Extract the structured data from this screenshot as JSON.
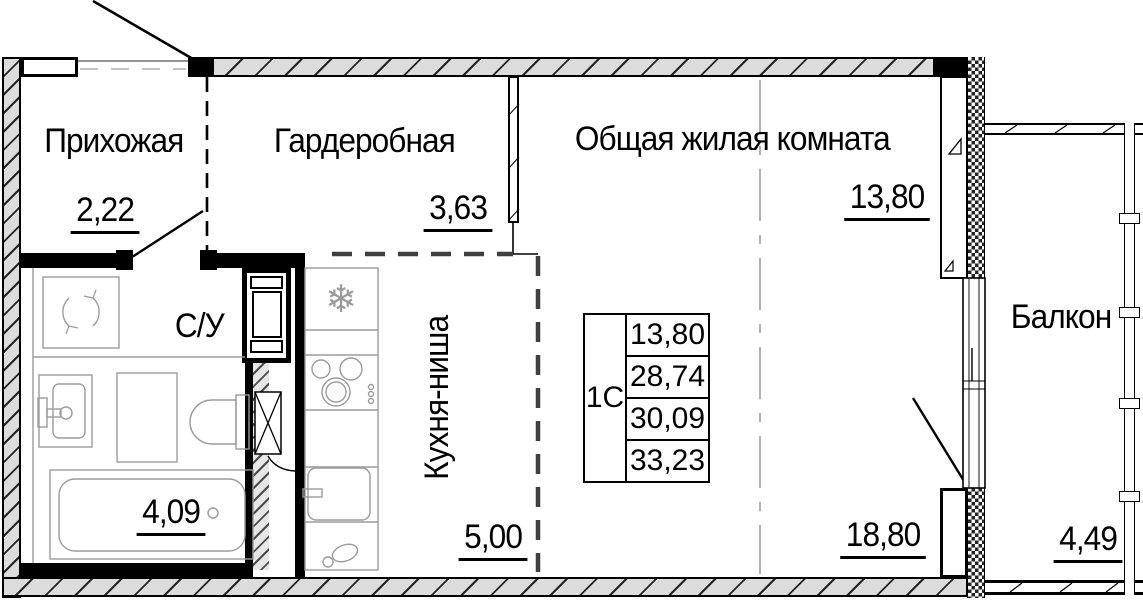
{
  "meta": {
    "type": "apartment floor plan (studio)",
    "language": "ru"
  },
  "rooms": [
    {
      "id": "hallway",
      "label": "Прихожая",
      "area": "2,22"
    },
    {
      "id": "wardrobe",
      "label": "Гардеробная",
      "area": "3,63"
    },
    {
      "id": "living_room",
      "label": "Общая жилая комната",
      "area": "13,80"
    },
    {
      "id": "bathroom",
      "label": "С/У",
      "area": "4,09"
    },
    {
      "id": "kitchen_niche",
      "label": "Кухня-ниша",
      "area": "5,00"
    },
    {
      "id": "room_zone",
      "label": "",
      "area": "18,80"
    },
    {
      "id": "balcony",
      "label": "Балкон",
      "area": "4,49"
    }
  ],
  "area_table": {
    "unit": "1С",
    "rows": [
      "13,80",
      "28,74",
      "30,09",
      "33,23"
    ]
  },
  "icons": {
    "snowflake": "❄"
  },
  "colors": {
    "line": "#000000",
    "fixture": "#9b9b9b",
    "hatch_fill": "#dcdcdc",
    "kitchen_dash": "#3f3f3f",
    "zone_dash": "#909090"
  }
}
